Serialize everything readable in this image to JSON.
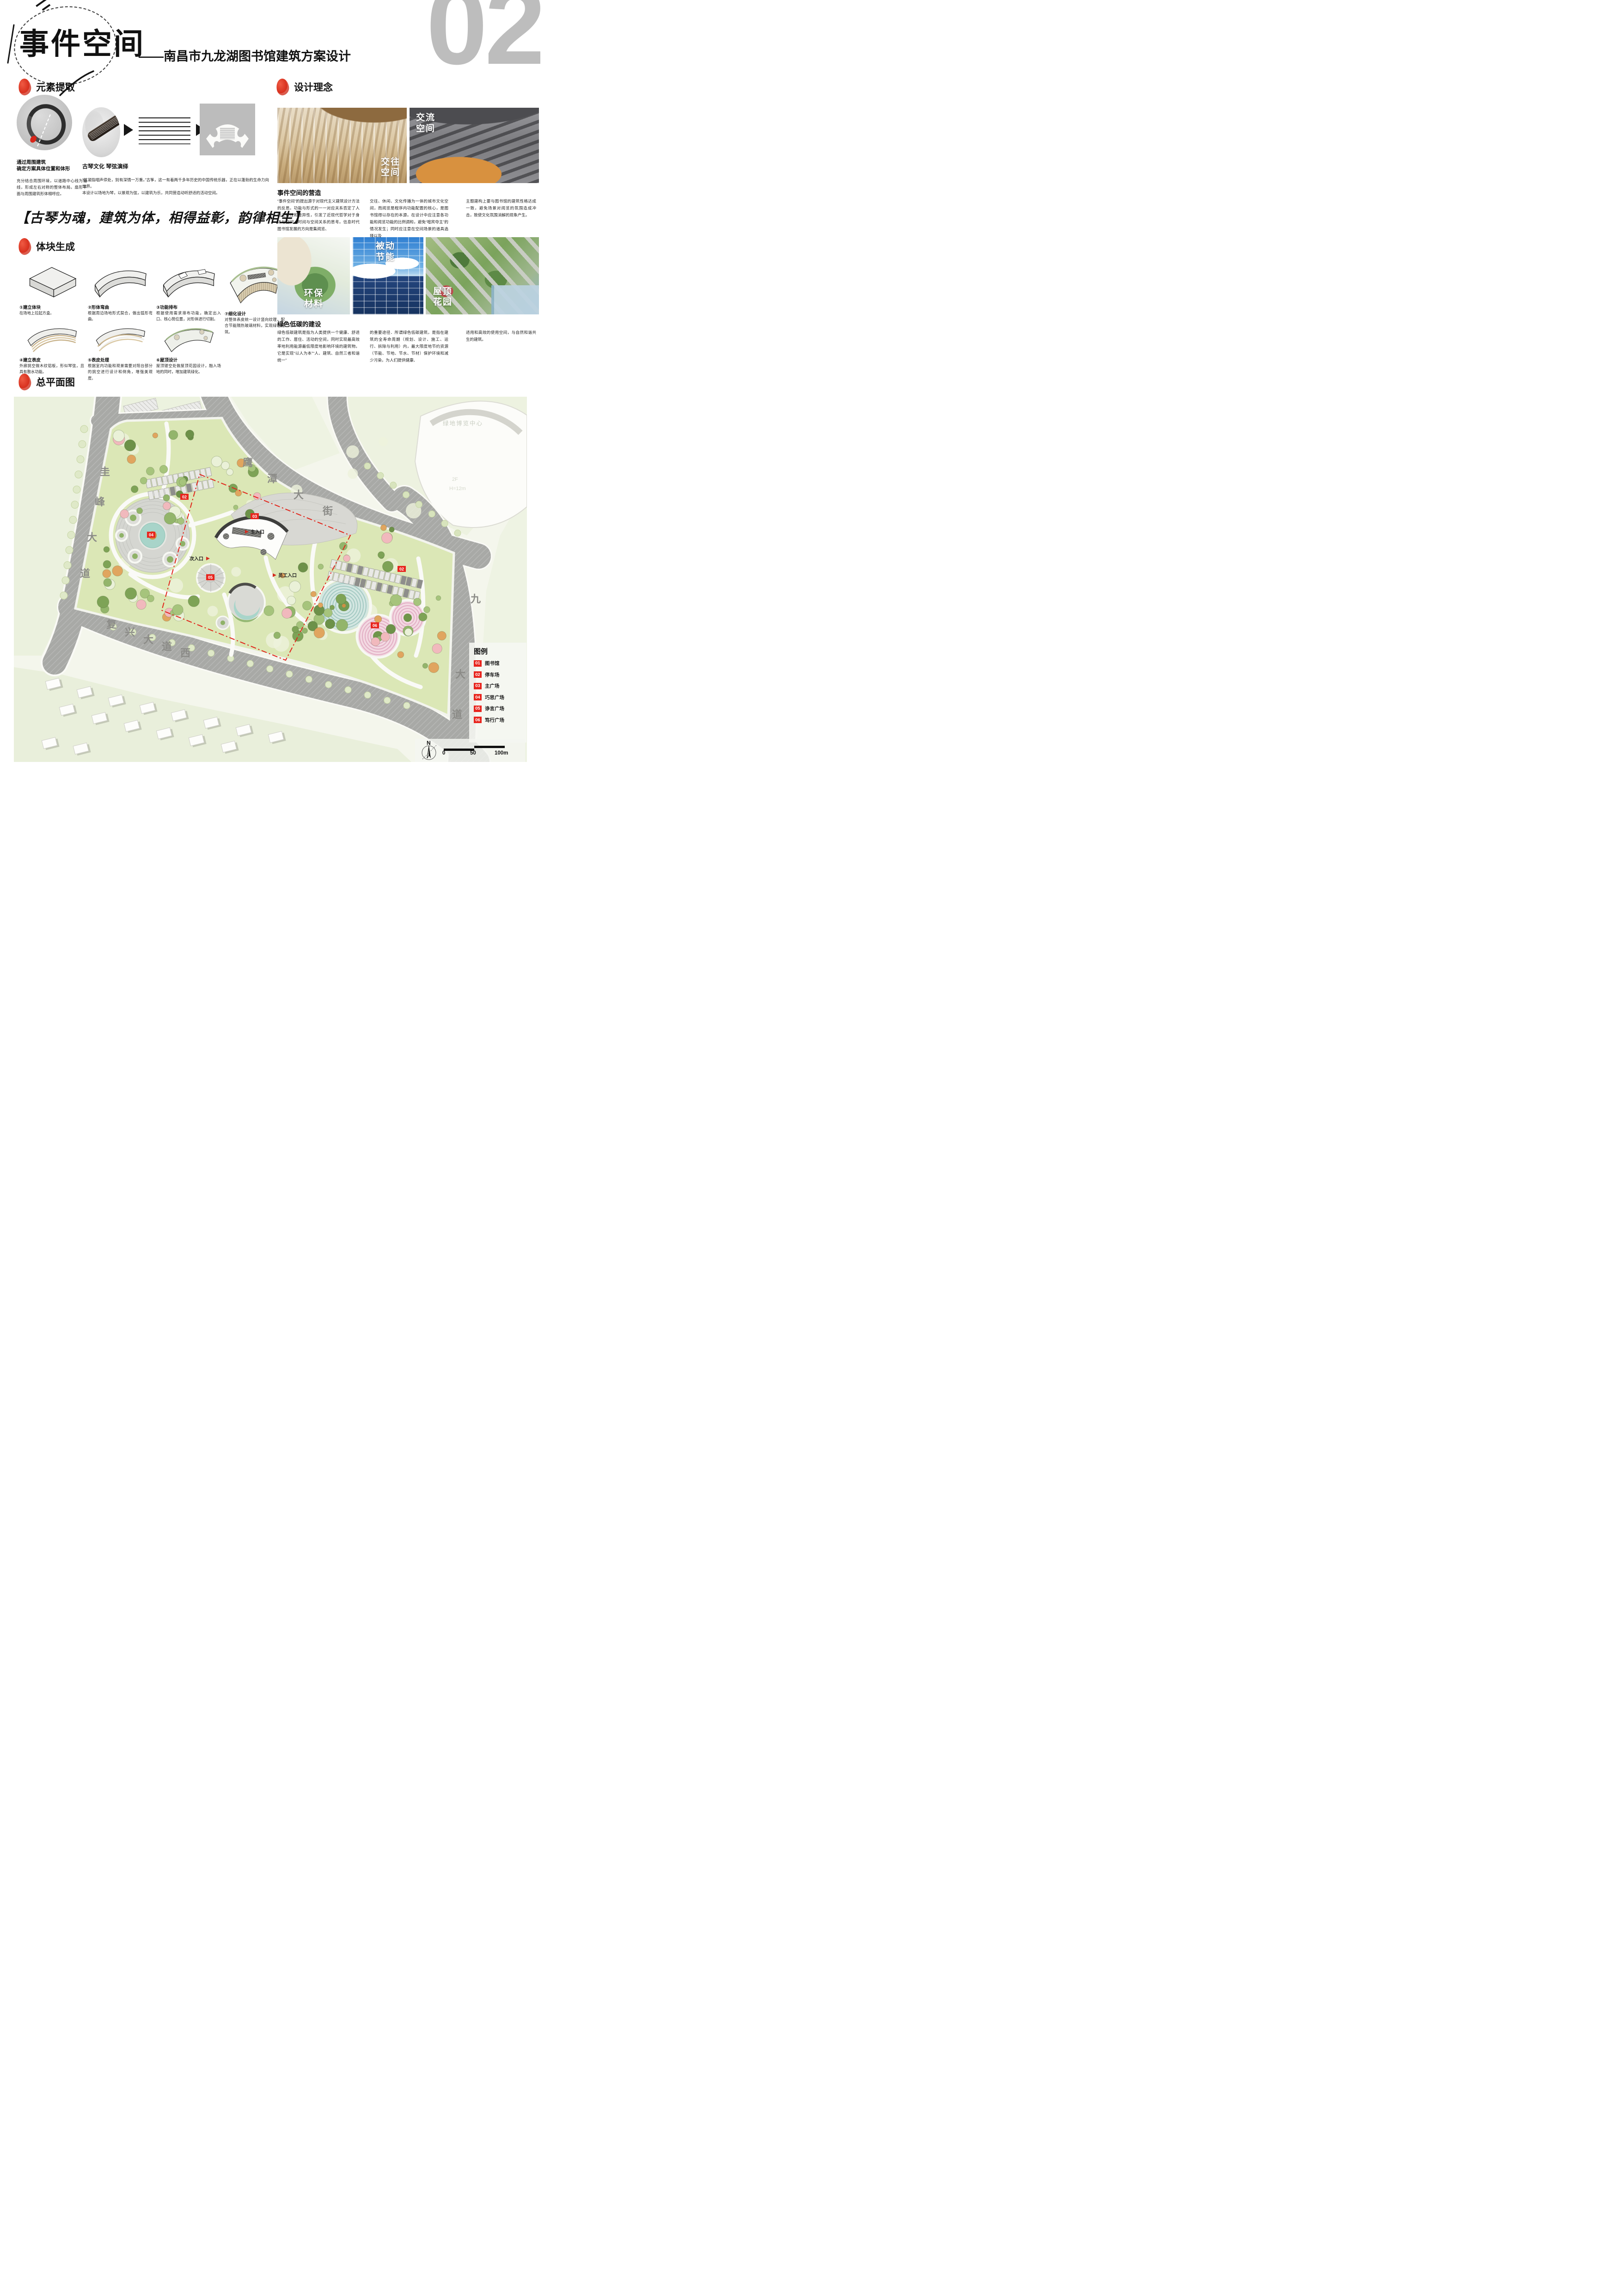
{
  "page_number": "02",
  "header": {
    "title": "事件空间",
    "subtitle": "——南昌市九龙湖图书馆建筑方案设计"
  },
  "element_extraction": {
    "section_title": "元素提取",
    "left_caption_l1": "通过周围建筑",
    "left_caption_l2": "确定方案具体位置和体形",
    "left_text": "充分结合周围环境，以道路中心线为轴线，形成左右对称的整体布局。扇形平面与周围建筑形体相呼应。",
    "right_caption": "古琴文化 琴弦演绎",
    "right_text_1": "“弦凝指咽声停处，别有深情一万重。”古筝，这一有着两千多年历史的中国传统乐器，正在以蓬勃的生命力向世界。",
    "right_text_2": "本设计以场地为琴，以景观为弦，以建筑为乐，共同营造动听舒适的活动空间。"
  },
  "design_concept": {
    "section_title": "设计理念",
    "photos": [
      {
        "label_l1": "交往",
        "label_l2": "空间"
      },
      {
        "label_l1": "交流",
        "label_l2": "空间"
      }
    ],
    "sub_title": "事件空间的营造",
    "columns": [
      "“事件空间”的提出源于对现代主义建筑设计方法的反思。功能与形式的一一对应关系否定了人的主观性和差异性，引发了近现代哲学对于身体与空间、时间与空间关系的思考。信息时代图书馆发展的方向是集阅览、",
      "交往、休闲、文化传播为一体的城市文化空间，而阅览是程序内功能配置的核心，是图书馆得以存在的本源。在设计中应注意各功能和阅览功能的比例调和，避免“喧宾夺主”的情况发生；同时应注意在空间场景的道具选择以及",
      "主题建构上要与图书馆的建筑性格达成一致，避免场景对阅览的氛围造成冲击，致使文化氛围消解的现象产生。"
    ]
  },
  "motto": "【古琴为魂，建筑为体，相得益彰，韵律相生】",
  "massing": {
    "section_title": "体块生成",
    "steps": [
      {
        "num": "①",
        "name": "建立体块",
        "desc": "在场地上拉起方盒。"
      },
      {
        "num": "②",
        "name": "形体弯曲",
        "desc": "根据周边场地形式契合，做出弧形弯曲。"
      },
      {
        "num": "③",
        "name": "功能排布",
        "desc": "根据使用需求排布功能，确定出入口、核心筒位置，对形体进行切割。"
      },
      {
        "num": "④",
        "name": "建立表皮",
        "desc": "外廊挑空做木纹铝板，形似琴弦，且具有散水功能。"
      },
      {
        "num": "⑤",
        "name": "表皮处理",
        "desc": "根据室内功能和观景需要对阳台部分的挑空进行设计和倒角，增强美观度。"
      },
      {
        "num": "⑥",
        "name": "屋顶设计",
        "desc": "屋顶镂空处做屋顶花园设计，融入场地的同时，增加建筑绿化。"
      },
      {
        "num": "⑦",
        "name": "细化设计",
        "desc": "对整体表皮统一设计竖向纹理，配合节能隔热玻璃材料，实现绿色建筑。"
      }
    ]
  },
  "green_building": {
    "photos": [
      {
        "label_l1": "环保",
        "label_l2": "材料"
      },
      {
        "label_l1": "被动",
        "label_l2": "节能"
      },
      {
        "label_l1": "屋顶",
        "label_l2": "花园"
      }
    ],
    "sub_title": "绿色低碳的建设",
    "columns": [
      "绿色低碳建筑是指为人类提供一个健康、舒适的工作、居住、活动的空间，同时实现最高效率地利用能源最低限度地影响环境的建筑物。它是实现“以人为本”“人、建筑、自然三者和谐统一”",
      "的重要途径．所谓绿色低碳建筑，是指在建筑的全寿命周期（规划、设计、施工、运行、拆除与利用）内，最大限度地节约资源（节能、节地、节水、节材）保护环境和减少污染，为人们提供健康、",
      "适用和高效的使用空间，与自然和谐共生的建筑。"
    ]
  },
  "master_plan": {
    "section_title": "总平面图",
    "roads": {
      "west": {
        "name": "圭峰大道",
        "chars": [
          "圭",
          "峰",
          "大",
          "道"
        ]
      },
      "north": {
        "name": "鹰潭大街",
        "chars": [
          "鹰",
          "潭",
          "大",
          "街"
        ]
      },
      "south": {
        "name": "复兴大道西",
        "chars": [
          "复",
          "兴",
          "大",
          "道",
          "西"
        ]
      },
      "east": {
        "name": "九龙大道",
        "chars": [
          "九",
          "龙",
          "大",
          "道"
        ]
      }
    },
    "entrances": {
      "main": "主入口",
      "secondary": "次入口",
      "staff": "员工入口"
    },
    "bg_building": {
      "name": "绿地博览中心",
      "floors": "2F",
      "height": "H=12m"
    },
    "markers": [
      {
        "num": "02"
      },
      {
        "num": "03"
      },
      {
        "num": "04"
      },
      {
        "num": "05"
      },
      {
        "num": "02"
      },
      {
        "num": "06"
      }
    ],
    "legend": {
      "title": "图例",
      "items": [
        {
          "num": "01",
          "label": "图书馆"
        },
        {
          "num": "02",
          "label": "停车场"
        },
        {
          "num": "03",
          "label": "主广场"
        },
        {
          "num": "04",
          "label": "巧思广场"
        },
        {
          "num": "05",
          "label": "诤言广场"
        },
        {
          "num": "06",
          "label": "笃行广场"
        }
      ]
    },
    "compass": "N",
    "scale_labels": [
      "0",
      "50",
      "100m"
    ]
  },
  "colors": {
    "accent_red": "#e03a2a",
    "page_num_gray": "#bdbdbd"
  }
}
